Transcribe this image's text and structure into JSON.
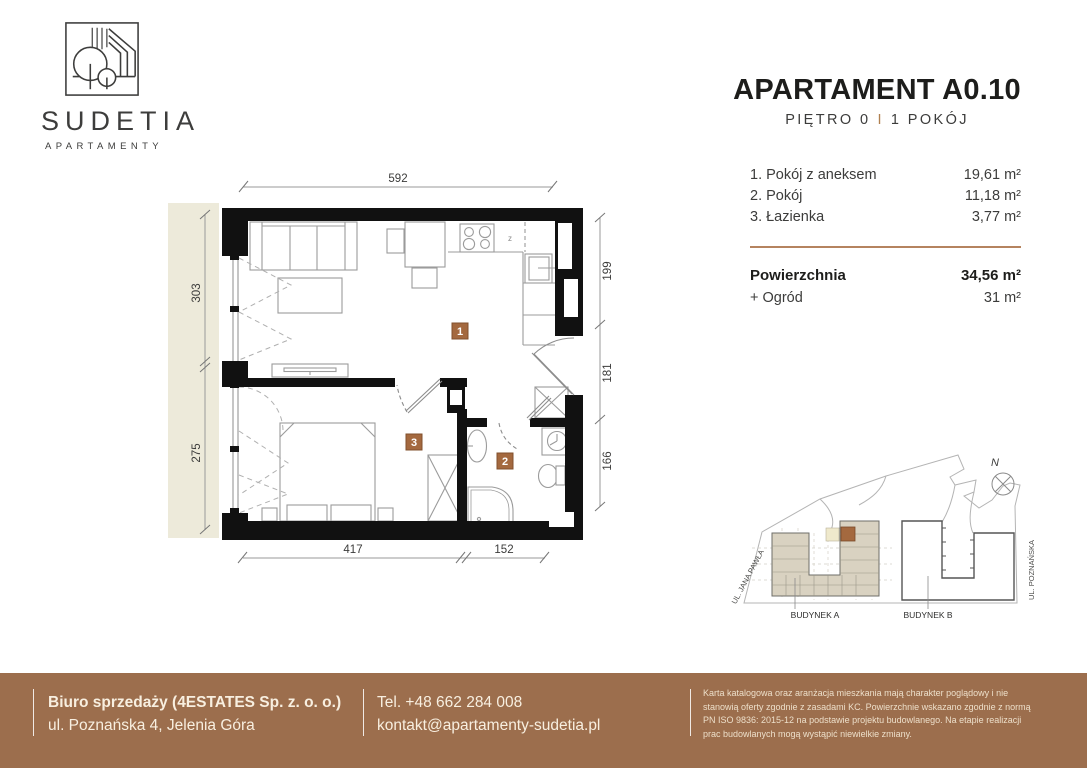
{
  "brand": {
    "name": "SUDETIA",
    "tagline": "APARTAMENTY"
  },
  "header": {
    "title": "APARTAMENT A0.10",
    "floor": "PIĘTRO 0",
    "separator": "I",
    "rooms": "1 POKÓJ"
  },
  "rooms": {
    "items": [
      {
        "label": "1. Pokój z aneksem",
        "area": "19,61 m²"
      },
      {
        "label": "2. Pokój",
        "area": "11,18 m²"
      },
      {
        "label": "3. Łazienka",
        "area": "3,77 m²"
      }
    ],
    "total_label": "Powierzchnia",
    "total_area": "34,56 m²",
    "garden_label": "+ Ogród",
    "garden_area": "31 m²"
  },
  "floor_plan": {
    "dim_top": "592",
    "dim_left_top": "303",
    "dim_left_bottom": "275",
    "dim_right_top": "199",
    "dim_right_middle": "181",
    "dim_right_bottom": "166",
    "dim_bottom_left": "417",
    "dim_bottom_right": "152",
    "marker_living": "1",
    "marker_bedroom": "3",
    "marker_bathroom": "2",
    "kitchen_z": "z"
  },
  "site_plan": {
    "building_a": "BUDYNEK A",
    "building_b": "BUDYNEK B",
    "street_left": "UL. JANA PAWŁA",
    "street_right": "UL. POZNAŃSKA",
    "compass": "N"
  },
  "footer": {
    "office_line1": "Biuro sprzedaży (4ESTATES Sp. z. o. o.)",
    "office_line2": "ul. Poznańska 4, Jelenia Góra",
    "phone": "Tel. +48 662 284 008",
    "email": "kontakt@apartamenty-sudetia.pl",
    "disclaimer": "Karta katalogowa oraz aranżacja mieszkania mają charakter poglądowy i nie stanowią oferty zgodnie z zasadami KC. Powierzchnie wskazano zgodnie z normą PN ISO 9836: 2015-12 na podstawie projektu budowlanego. Na etapie realizacji prac budowlanych mogą wystąpić niewielkie zmiany."
  },
  "colors": {
    "accent_brown": "#a4693f",
    "footer_brown": "#9c6e4d",
    "garden_beige": "#edeada"
  }
}
